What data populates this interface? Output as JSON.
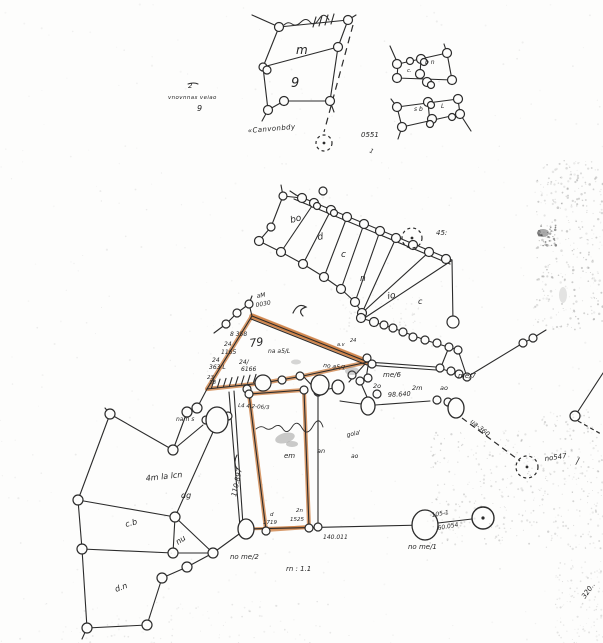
{
  "colors": {
    "ink": "#2b2b2b",
    "highlight": "#cd7f42",
    "paper": "#fdfdfc"
  },
  "labels": {
    "topleft": {
      "note_num": "2",
      "note_line": "vnovnnas veiao",
      "note_q": "9",
      "plot_m": "m",
      "plot_9": "9",
      "canal": "«Canvonbdy",
      "n0551": "0551",
      "slash": "1"
    },
    "topright": {
      "a1": "b n",
      "a2": "c.",
      "b1": "s b",
      "b2": "L"
    },
    "ne": {
      "n45": "45:",
      "p60": "bo",
      "p1": "d",
      "p2": "c",
      "p3": "n",
      "p4": "io",
      "p5": "c"
    },
    "tri": {
      "am": "aM",
      "n0030": "0030",
      "n8358": "8 358",
      "n24a": "24",
      "n1165": "1165",
      "n79": "79",
      "owner": "na a5/L",
      "n24b": "24/",
      "n6166": "6166",
      "n24c": "24",
      "n363": "363 L",
      "n23": "23",
      "n18": "18",
      "edge_label": "no a5/1",
      "n24tip": "24",
      "ntip": "a.v",
      "survey": "L4 4.2-06/3"
    },
    "east": {
      "me6": "me/6",
      "n2o": "2o",
      "n2m": "2m",
      "nao": "ao",
      "me7": "me/7",
      "d98": "98.640"
    },
    "west": {
      "nam": "nam s",
      "area": "4m la lcn",
      "dg": "dg",
      "d110": "110.897",
      "bl1": "c.b",
      "bl2": "nu",
      "bl3": "d.n"
    },
    "parcel": {
      "em": "em",
      "an": "an",
      "note": "gola'",
      "ao2": "ao"
    },
    "bottom": {
      "d1": "d",
      "n1719": "1719",
      "n2n": "2n",
      "n1525": "1525",
      "d140": "140.011",
      "nome2": "no me/2",
      "rn": "rn : 1.1",
      "d105": "105-1",
      "d60": "60.054",
      "nome1": "no me/1"
    },
    "right": {
      "ua360": "ua-360",
      "no547": "no547",
      "slash": "/",
      "n320": "320.."
    }
  }
}
